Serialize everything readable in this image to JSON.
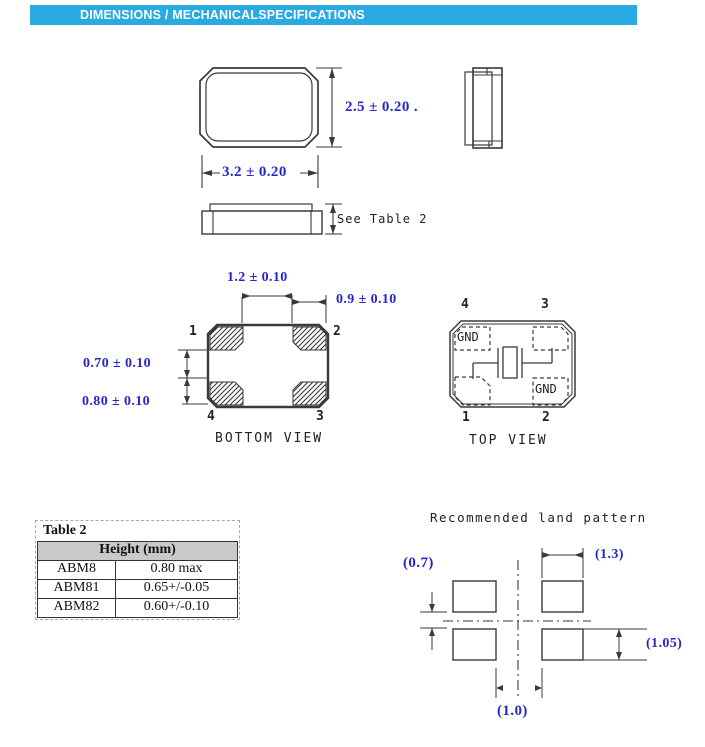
{
  "header": {
    "title": "DIMENSIONS / MECHANICALSPECIFICATIONS"
  },
  "front_view": {
    "dim_height": "2.5 ± 0.20 .",
    "dim_width": "3.2 ± 0.20"
  },
  "side_view": {
    "height_note": "See Table 2"
  },
  "bottom_view": {
    "label": "BOTTOM VIEW",
    "dim_pad_gap_h": "1.2 ± 0.10",
    "dim_pad_width": "0.9 ± 0.10",
    "dim_pad_gap_v": "0.70 ± 0.10",
    "dim_pad_height": "0.80 ± 0.10",
    "pins": {
      "p1": "1",
      "p2": "2",
      "p3": "3",
      "p4": "4"
    }
  },
  "top_view": {
    "label": "TOP VIEW",
    "gnd_top_left": "GND",
    "gnd_bottom_right": "GND",
    "pins": {
      "p1": "1",
      "p2": "2",
      "p3": "3",
      "p4": "4"
    }
  },
  "land_pattern": {
    "title": "Recommended land pattern",
    "dim_gap_v": "(0.7)",
    "dim_pad_w": "(1.3)",
    "dim_pad_h": "(1.05)",
    "dim_gap_h": "(1.0)"
  },
  "table2": {
    "title": "Table 2",
    "header": "Height (mm)",
    "rows": [
      {
        "model": "ABM8",
        "height": "0.80 max"
      },
      {
        "model": "ABM81",
        "height": "0.65+/-0.05"
      },
      {
        "model": "ABM82",
        "height": "0.60+/-0.10"
      }
    ]
  },
  "colors": {
    "banner": "#29ABE2",
    "dimension_text": "#2626C9",
    "line": "#3a3a3a",
    "table_header_bg": "#C9C9C9"
  }
}
